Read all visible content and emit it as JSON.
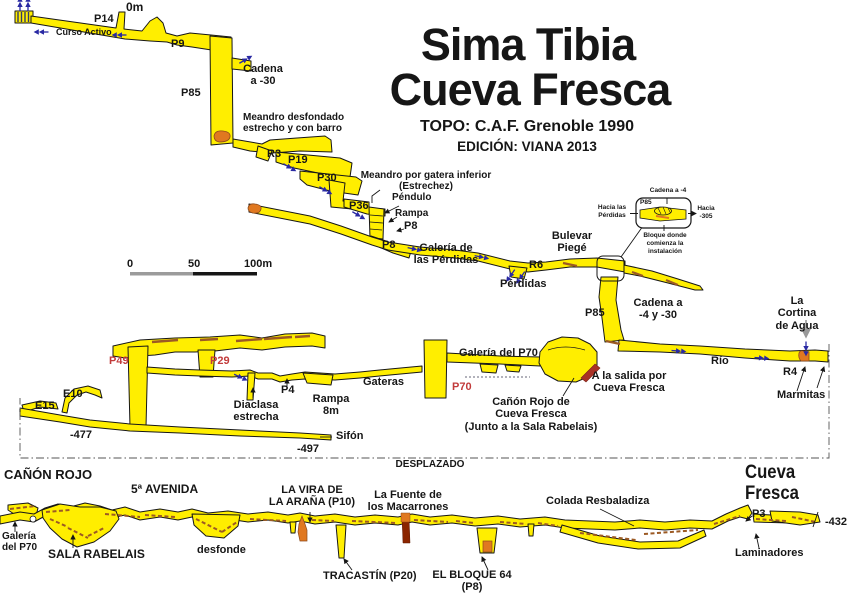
{
  "header": {
    "title_line1": "Sima Tibia",
    "title_line2": "Cueva Fresca",
    "topo": "TOPO: C.A.F. Grenoble 1990",
    "edition": "EDICIÓN: VIANA 2013"
  },
  "scale_bar": {
    "label_0": "0",
    "label_50": "50",
    "label_100": "100m"
  },
  "colors": {
    "passage_yellow": "#FFEE00",
    "outline_black": "#161616",
    "accent_red": "#C23B3B",
    "flow_blue": "#2929A3",
    "rubble_brown": "#9C5A24",
    "formation_orange": "#E07820"
  },
  "labels": {
    "om": "0m",
    "p14": "P14",
    "curso_activo": "Curso Activo",
    "p9": "P9",
    "cadena_a_30": "Cadena\na -30",
    "p85_upper": "P85",
    "meandro_desfondado": "Meandro desfondado\nestrecho y con barro",
    "r3": "R3",
    "p19": "P19",
    "p30": "P30",
    "meandro_gatera": "Meandro por gatera inferior\n(Estrechez)",
    "pendulo": "Péndulo",
    "p36": "P36",
    "rampa": "Rampa",
    "p8_a": "P8",
    "p8_b": "P8",
    "galeria_perdidas": "Galería de\nlas Pérdidas",
    "r6": "R6",
    "perdidas": "Pérdidas",
    "bulevar_piege": "Bulevar\nPiegé",
    "inset_cadena_a_4": "Cadena a -4",
    "inset_p85": "P85",
    "inset_hacia_perdidas": "Hacia las\nPérdidas",
    "inset_hacia_305": "Hacia\n-305",
    "inset_bloque": "Bloque donde\ncomienza la\ninstalación",
    "p85_mid": "P85",
    "cadena_a_4_30": "Cadena a\n-4 y -30",
    "cortina": "La Cortina\nde Agua",
    "rio": "Río",
    "r4": "R4",
    "marmitas": "Marmitas",
    "p49": "P49",
    "p29": "P29",
    "e10": "E10",
    "e15": "E15",
    "diaclasa": "Diaclasa\nestrecha",
    "p4": "P4",
    "rampa_8m": "Rampa\n8m",
    "gateras": "Gateras",
    "galeria_p70": "Galería del P70",
    "p70": "P70",
    "salida_cueva_fresca": "A la salida por\nCueva Fresca",
    "canon_rojo_cf": "Cañón Rojo de\nCueva Fresca\n(Junto a la Sala Rabelais)",
    "sifon": "Sifón",
    "depth_477": "-477",
    "depth_497": "-497",
    "desplazado": "DESPLAZADO",
    "canon_rojo": "CAÑÓN ROJO",
    "quinta_avenida": "5ª AVENIDA",
    "vira_arana": "LA VIRA DE\nLA ARAÑA (P10)",
    "fuente_macarrones": "La Fuente de\nlos Macarrones",
    "colada": "Colada Resbaladiza",
    "cueva_fresca": "Cueva Fresca",
    "galeria_p70_bottom": "Galería\ndel P70",
    "sala_rabelais": "SALA RABELAIS",
    "desfonde": "desfonde",
    "tracastin": "TRACASTÍN (P20)",
    "bloque_64": "EL BLOQUE 64\n(P8)",
    "p3": "P3",
    "depth_432": "-432",
    "laminadores": "Laminadores"
  }
}
